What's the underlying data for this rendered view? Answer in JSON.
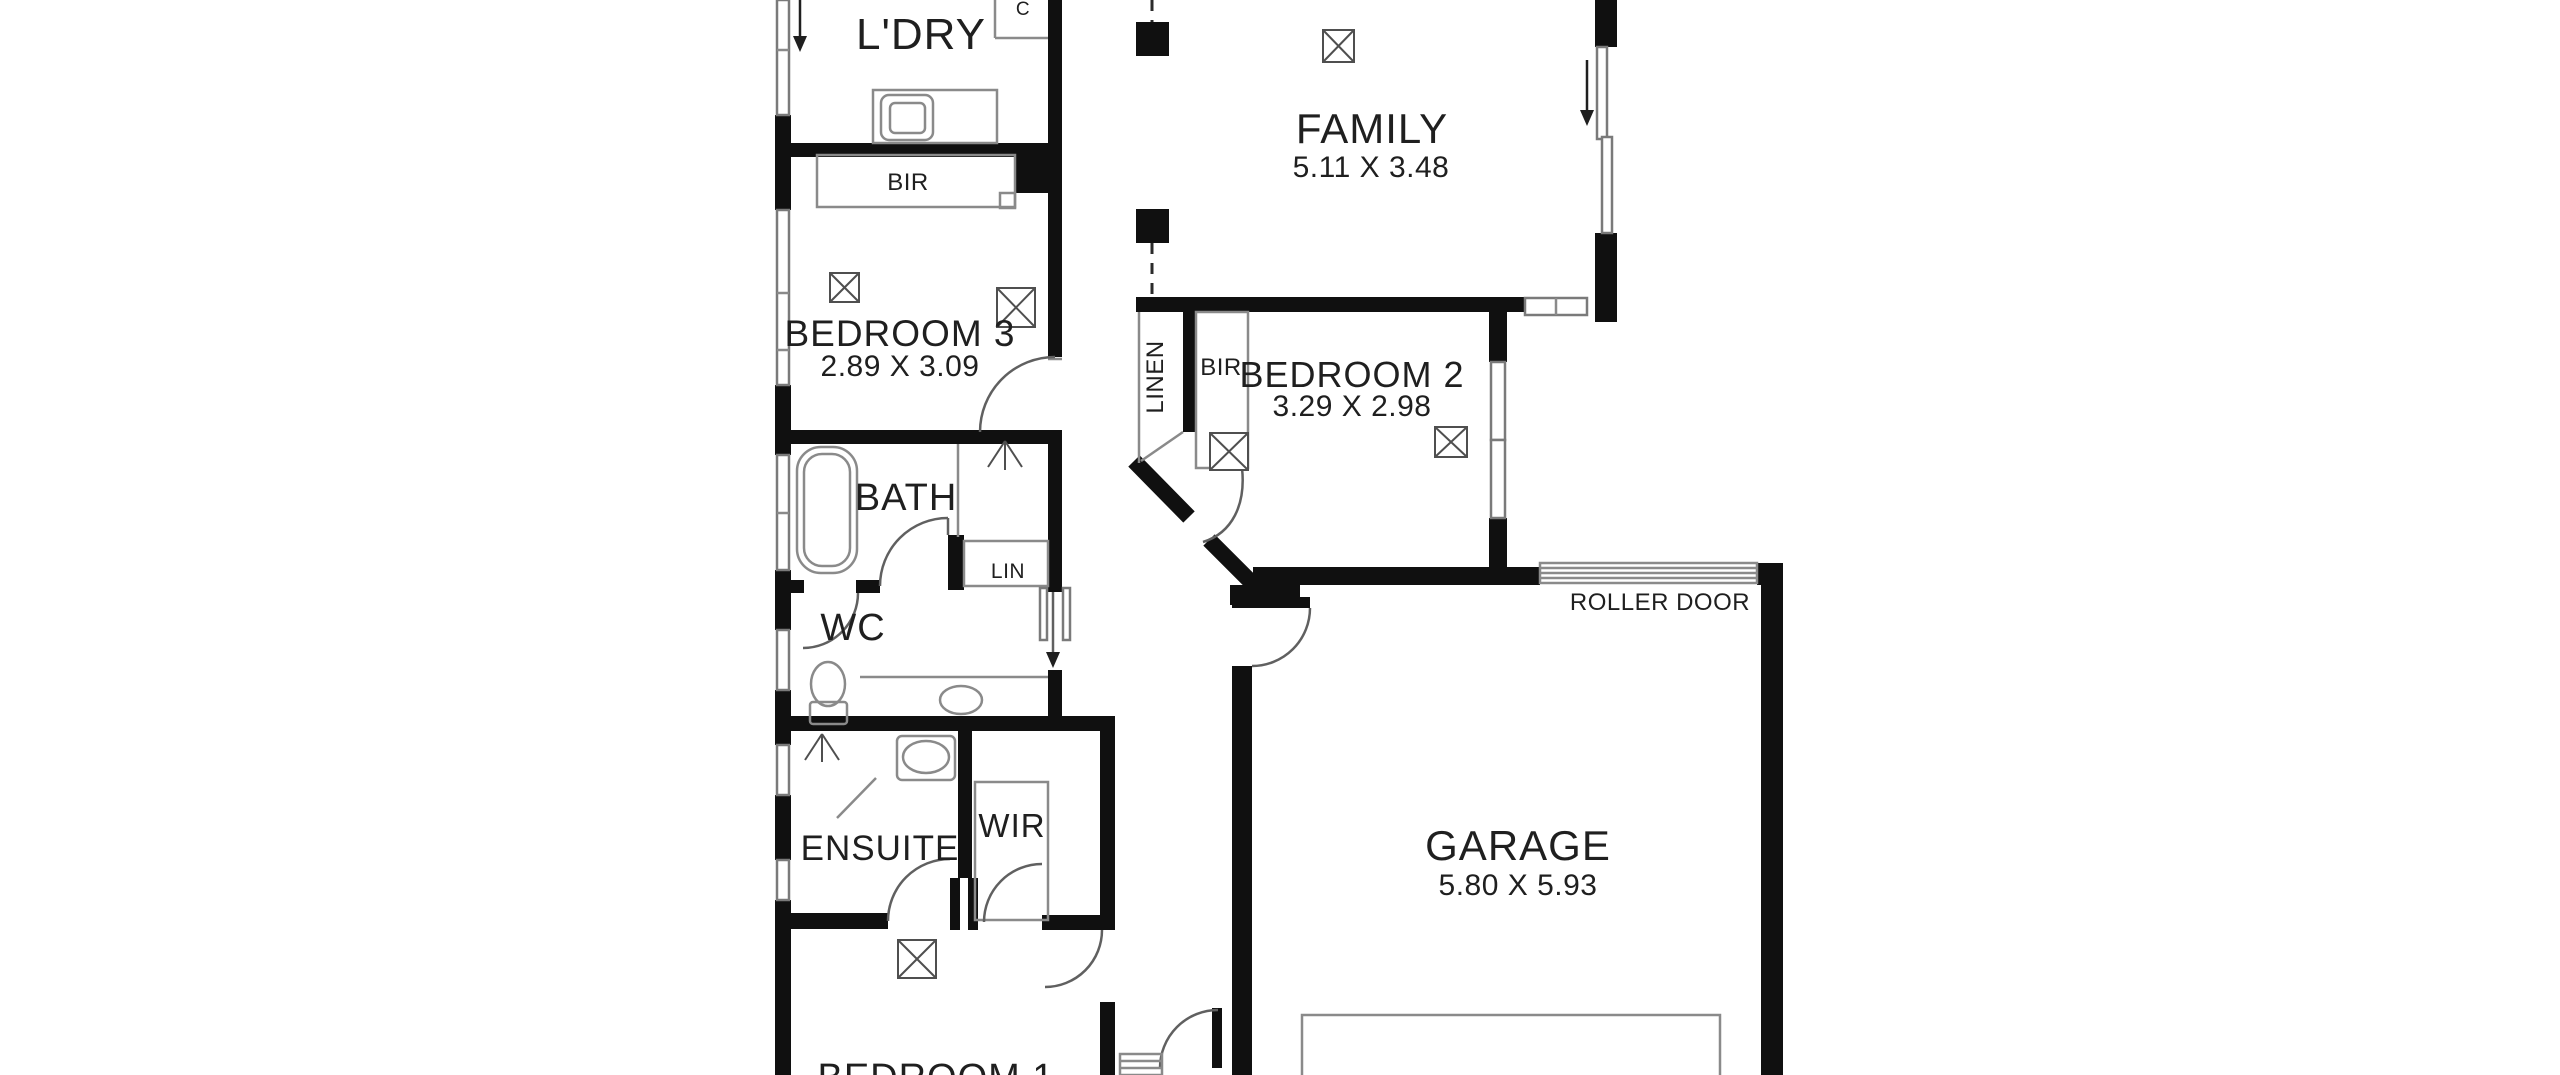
{
  "plan": {
    "title": "Single storey house floor plan",
    "rooms": {
      "laundry": {
        "name": "L'DRY",
        "dims": ""
      },
      "family": {
        "name": "FAMILY",
        "dims": "5.11 X 3.48"
      },
      "bedroom3": {
        "name": "BEDROOM 3",
        "dims": "2.89 X 3.09"
      },
      "bedroom2": {
        "name": "BEDROOM 2",
        "dims": "3.29 X 2.98"
      },
      "bath": {
        "name": "BATH",
        "dims": ""
      },
      "wc": {
        "name": "WC",
        "dims": ""
      },
      "ensuite": {
        "name": "ENSUITE",
        "dims": ""
      },
      "wir": {
        "name": "WIR",
        "dims": ""
      },
      "garage": {
        "name": "GARAGE",
        "dims": "5.80 X 5.93"
      },
      "bedroom1": {
        "name": "BEDROOM 1",
        "dims": ""
      }
    },
    "closets": {
      "bir_bed3": "BIR",
      "bir_bed2": "BIR",
      "linen": "LINEN",
      "lin": "LIN",
      "cupboard": "C"
    },
    "labels": {
      "roller_door": "ROLLER DOOR"
    },
    "symbols": {
      "cross_box": "ceiling-light-symbol",
      "door_arc": "door-swing-arc",
      "window": "window-double-line",
      "entry_arrow": "entry-direction-arrow",
      "slider_arrow": "sliding-door-arrow",
      "bathtub": "bathtub",
      "toilet": "toilet",
      "basin": "basin-oval",
      "washing_machine": "washing-machine",
      "shower": "shower-arrow",
      "steps": "entry-steps"
    },
    "colors": {
      "background": "#ffffff",
      "wall": "#101010",
      "fixture_line": "#8a8a8a",
      "door_line": "#606060",
      "text": "#1f1f1f"
    }
  }
}
